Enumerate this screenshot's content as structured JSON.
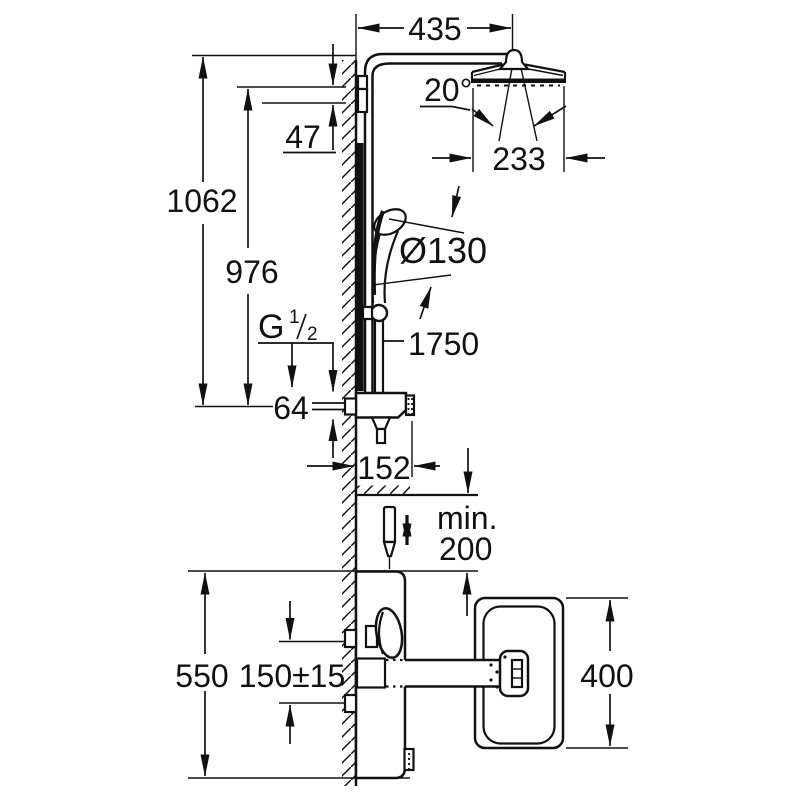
{
  "drawing": {
    "type": "technical-dimension-drawing",
    "subject": "shower system with thermostat and bath spout",
    "units": "mm",
    "colors": {
      "line": "#111111",
      "background": "#ffffff"
    },
    "dims": {
      "arm_projection": "435",
      "spray_angle": "20°",
      "head_diameter": "233",
      "total_height": "1062",
      "rail_height": "976",
      "bracket_offset": "47",
      "hand_shower_diameter": "Ø130",
      "hose_length": "1750",
      "body_height": "64",
      "body_depth": "152",
      "min_clearance_word": "min.",
      "min_clearance_value": "200",
      "install_height": "550",
      "connection_spacing": "150±15",
      "basin_width": "400"
    },
    "thread": {
      "letter": "G",
      "numerator": "1",
      "denominator": "2"
    }
  }
}
